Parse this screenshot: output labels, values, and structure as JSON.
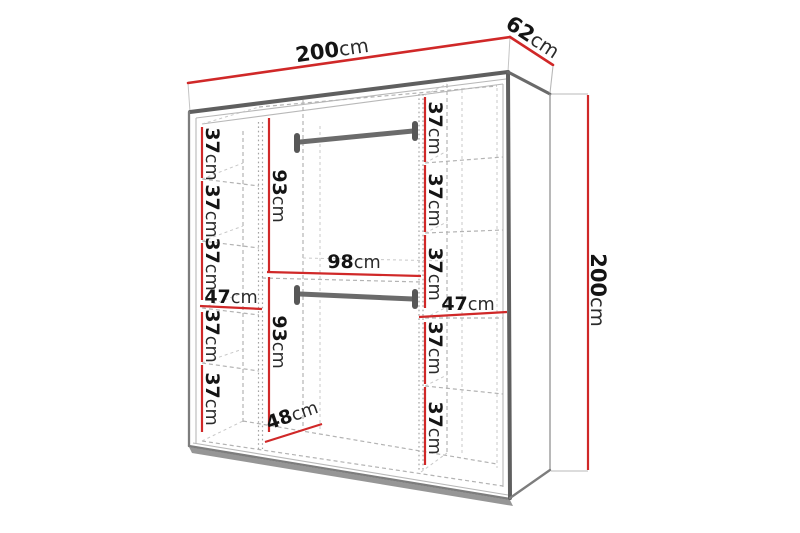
{
  "outer_dimensions": {
    "width": {
      "num": "200",
      "unit": "cm"
    },
    "depth": {
      "num": "62",
      "unit": "cm"
    },
    "height": {
      "num": "200",
      "unit": "cm"
    }
  },
  "interior": {
    "left_column": [
      {
        "num": "37",
        "unit": "cm"
      },
      {
        "num": "37",
        "unit": "cm"
      },
      {
        "num": "37",
        "unit": "cm"
      },
      {
        "num": "47",
        "unit": "cm"
      },
      {
        "num": "37",
        "unit": "cm"
      },
      {
        "num": "37",
        "unit": "cm"
      }
    ],
    "center_column": {
      "upper_height": {
        "num": "93",
        "unit": "cm"
      },
      "middle_width": {
        "num": "98",
        "unit": "cm"
      },
      "lower_height": {
        "num": "93",
        "unit": "cm"
      },
      "bottom_depth": {
        "num": "48",
        "unit": "cm"
      }
    },
    "right_column": [
      {
        "num": "37",
        "unit": "cm"
      },
      {
        "num": "37",
        "unit": "cm"
      },
      {
        "num": "37",
        "unit": "cm"
      },
      {
        "num": "47",
        "unit": "cm"
      },
      {
        "num": "37",
        "unit": "cm"
      },
      {
        "num": "37",
        "unit": "cm"
      }
    ]
  },
  "colors": {
    "dimension_line": "#d02828",
    "outline_dark": "#5f5f5f",
    "outline_light": "#9a9a9a",
    "dashed_line": "#b3b3b3",
    "rail": "#6b6b6b",
    "label_text": "#141414",
    "background": "#ffffff"
  }
}
